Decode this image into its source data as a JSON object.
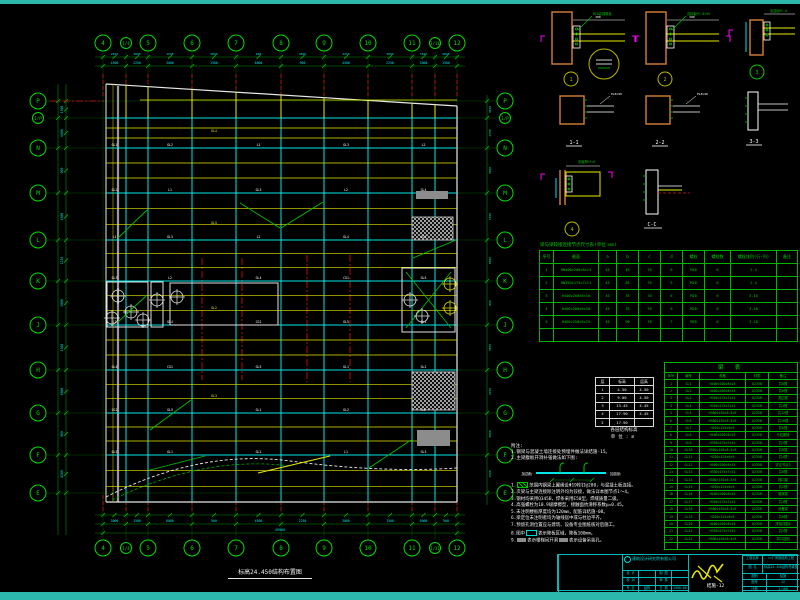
{
  "colors": {
    "teal": "#2db8ae",
    "green": "#00c000",
    "dim_green": "#009000",
    "cyan": "#00e5e5",
    "yellow": "#e8e800",
    "red": "#dd1010",
    "magenta": "#ff00ff",
    "orange": "#c87832",
    "white": "#e8e8e8",
    "gray": "#8c8c8c",
    "bubble": "#00dd00",
    "detail_ring": "#b8b800"
  },
  "plan": {
    "title": "标高24.450结构布置图",
    "cols": [
      {
        "label": "4",
        "x": 103
      },
      {
        "label": "1/4",
        "x": 126,
        "small": true
      },
      {
        "label": "5",
        "x": 148
      },
      {
        "label": "6",
        "x": 192
      },
      {
        "label": "7",
        "x": 236
      },
      {
        "label": "8",
        "x": 281
      },
      {
        "label": "9",
        "x": 324
      },
      {
        "label": "10",
        "x": 368
      },
      {
        "label": "11",
        "x": 412
      },
      {
        "label": "1/11",
        "x": 435,
        "small": true
      },
      {
        "label": "12",
        "x": 457
      }
    ],
    "rows": [
      {
        "label": "P",
        "y": 101
      },
      {
        "label": "1/P",
        "y": 118,
        "small": true
      },
      {
        "label": "N",
        "y": 148
      },
      {
        "label": "M",
        "y": 193
      },
      {
        "label": "L",
        "y": 240
      },
      {
        "label": "K",
        "y": 281
      },
      {
        "label": "J",
        "y": 325
      },
      {
        "label": "H",
        "y": 370
      },
      {
        "label": "G",
        "y": 413
      },
      {
        "label": "F",
        "y": 455
      },
      {
        "label": "E",
        "y": 493
      }
    ],
    "label_pool": [
      "GL1",
      "GL2",
      "L1",
      "GL3",
      "L2",
      "GL4",
      "CG1",
      "GL5"
    ],
    "dim_pool": [
      "4500",
      "2250",
      "3000",
      "1500",
      "6000",
      "900"
    ],
    "overall_dim": "49500"
  },
  "details": {
    "ids": [
      "1",
      "2",
      "3",
      "4"
    ],
    "sections": [
      "1-1",
      "2-2",
      "3-3",
      "C-C"
    ],
    "leader_pool": [
      "M20高强螺栓",
      "连接板PL-8×90",
      "加劲肋PL-8",
      "双面焊hf=6"
    ],
    "plate_mark": "PL8×90",
    "dim_mark": "200"
  },
  "bolt_table": {
    "title": "梁与梁铰接连接节点尺寸表(单位:mm)",
    "headers": [
      "序号",
      "截面",
      "a",
      "b",
      "c",
      "d",
      "螺栓",
      "螺栓数",
      "螺栓排列(行-列)",
      "备注"
    ],
    "rows": [
      [
        "1",
        "HN400×200×8×13",
        "45",
        "45",
        "70",
        "6",
        "M20",
        "6",
        "2-4",
        ""
      ],
      [
        "2",
        "HN350×175×7×11",
        "45",
        "85",
        "70",
        "5",
        "M20",
        "6",
        "2-4",
        ""
      ],
      [
        "3",
        "H400×200×8×16",
        "45",
        "35",
        "70",
        "6",
        "M20",
        "6",
        "3-10",
        ""
      ],
      [
        "4",
        "H400×200×8×20",
        "45",
        "35",
        "70",
        "6",
        "M20",
        "6",
        "3-10",
        ""
      ],
      [
        "5",
        "H400×250×8×25",
        "45",
        "90",
        "70",
        "7",
        "M20",
        "6",
        "3-10",
        ""
      ],
      [
        "",
        "",
        "",
        "",
        "",
        "",
        "",
        "",
        "",
        ""
      ]
    ]
  },
  "member_table": {
    "title": "梁  表",
    "headers": [
      "序号",
      "编号",
      "规格",
      "材质",
      "备注"
    ],
    "rows": [
      [
        "1",
        "GL1",
        "H400×200×8×13",
        "Q235B",
        "共8根"
      ],
      [
        "2",
        "GL2",
        "H400×200×8×13",
        "Q235B",
        "共6根"
      ],
      [
        "3",
        "GL3",
        "H350×175×7×11",
        "Q235B",
        "洞边梁"
      ],
      [
        "4",
        "GL4",
        "H350×175×7×11",
        "Q235B",
        "共4根"
      ],
      [
        "5",
        "GL5",
        "H300×150×6.5×9",
        "Q235B",
        "共12根"
      ],
      [
        "6",
        "GL6",
        "H300×150×6.5×9",
        "Q235B",
        "共10根"
      ],
      [
        "7",
        "GL7",
        "H250×125×6×9",
        "Q235B",
        "共6根"
      ],
      [
        "8",
        "GL8",
        "H400×200×8×13",
        "Q235B",
        "与柱刚接"
      ],
      [
        "9",
        "GL9",
        "H350×175×7×11",
        "Q235B",
        "共2根"
      ],
      [
        "10",
        "GL10",
        "H300×150×6.5×9",
        "Q235B",
        "共8根"
      ],
      [
        "11",
        "GL11",
        "H250×125×6×9",
        "Q235B",
        "共4根"
      ],
      [
        "12",
        "GL12",
        "H400×200×8×13",
        "Q235B",
        "详见节点3"
      ],
      [
        "13",
        "GL13",
        "H350×175×7×11",
        "Q235B",
        "共6根"
      ],
      [
        "14",
        "GL14",
        "H300×150×6.5×9",
        "Q235B",
        "梯口梁"
      ],
      [
        "15",
        "GL15",
        "H250×125×6×9",
        "Q235B",
        "共2根"
      ],
      [
        "16",
        "GL16",
        "H400×200×8×13",
        "Q235B",
        "悬挑梁"
      ],
      [
        "17",
        "GL17",
        "H350×175×7×11",
        "Q235B",
        "共4根"
      ],
      [
        "18",
        "GL18",
        "H300×150×6.5×9",
        "Q235B",
        "设备梁"
      ],
      [
        "19",
        "GL19",
        "H250×125×6×9",
        "Q235B",
        "共6根"
      ],
      [
        "20",
        "GL20",
        "H400×200×8×13",
        "Q235B",
        "拼接详图4"
      ],
      [
        "21",
        "GL21",
        "H350×175×7×11",
        "Q235B",
        "共2根"
      ],
      [
        "22",
        "GL22",
        "H300×150×6.5×9",
        "Q235B",
        "洞口加固"
      ],
      [
        "",
        "",
        "",
        "",
        ""
      ]
    ]
  },
  "elevation_table": {
    "rows": [
      [
        "层",
        "标高",
        "层高"
      ],
      [
        "1",
        "4.50",
        "4.50"
      ],
      [
        "2",
        "9.00",
        "4.50"
      ],
      [
        "3",
        "13.45",
        "4.45"
      ],
      [
        "4",
        "17.90",
        "4.45"
      ],
      [
        "Σ",
        "17.90",
        ""
      ]
    ],
    "caption1": "各层结构标高",
    "caption2": "单位:m"
  },
  "fn": {
    "title": "附注:",
    "lines": [
      "1.钢梁与混凝土墙连接处预埋件做法详结施-15。",
      "2.主梁腹板开洞补强做法如下图:"
    ],
    "diagram_labels": [
      "加劲肋",
      "加劲肋"
    ]
  },
  "notes": {
    "items": [
      {
        "lead": "1.",
        "swatch": "sw-hatch",
        "text": "范围内钢梁上翼缘设Φ19栓钉@200，与混凝土板连接。"
      },
      {
        "lead": "2.",
        "text": "次梁与主梁连接除注明外均为铰接，做法详本图节点1～4。"
      },
      {
        "lead": "3.",
        "text": "钢材均采用Q345B，焊条采用E50型，焊缝质量二级。"
      },
      {
        "lead": "4.",
        "text": "高强螺栓为10.9级摩擦型，接触面抗滑移系数μ=0.45。"
      },
      {
        "lead": "5.",
        "text": "未注明楼板厚度均为120mm，配筋详结施-08。"
      },
      {
        "lead": "6.",
        "text": "梁定位未注明者均为轴线居中或与柱边平齐。"
      },
      {
        "lead": "7.",
        "text": "预留孔洞位置应与建筑、设备专业图纸核对后施工。"
      },
      {
        "lead": "8.图中",
        "swatch": "sw-cyan",
        "text": "表示降板区域，降板100mm。"
      },
      {
        "lead": "9.",
        "swatch": "sw-gray",
        "text": "表示楼梯间开洞",
        "swatch2": "sw-gray",
        "text2": "表示设备吊装孔。"
      }
    ]
  },
  "title_block": {
    "company": "建筑设计研究院有限公司",
    "sign_cells": [
      [
        "设 计",
        ""
      ],
      [
        "制 图",
        ""
      ],
      [
        "校 对",
        ""
      ],
      [
        "审 核",
        ""
      ],
      [
        "专 业",
        "结构"
      ],
      [
        "日 期",
        "2006.06"
      ]
    ],
    "project_label": "工程名称",
    "project": "××厂房钢结构工程",
    "name_label": "图 名",
    "name": "标高24.450结构布置图",
    "right_cells": [
      [
        "图别",
        "结施"
      ],
      [
        "图号",
        "12"
      ],
      [
        "比例",
        "1:100"
      ]
    ],
    "drawing_no": "结施-12"
  }
}
